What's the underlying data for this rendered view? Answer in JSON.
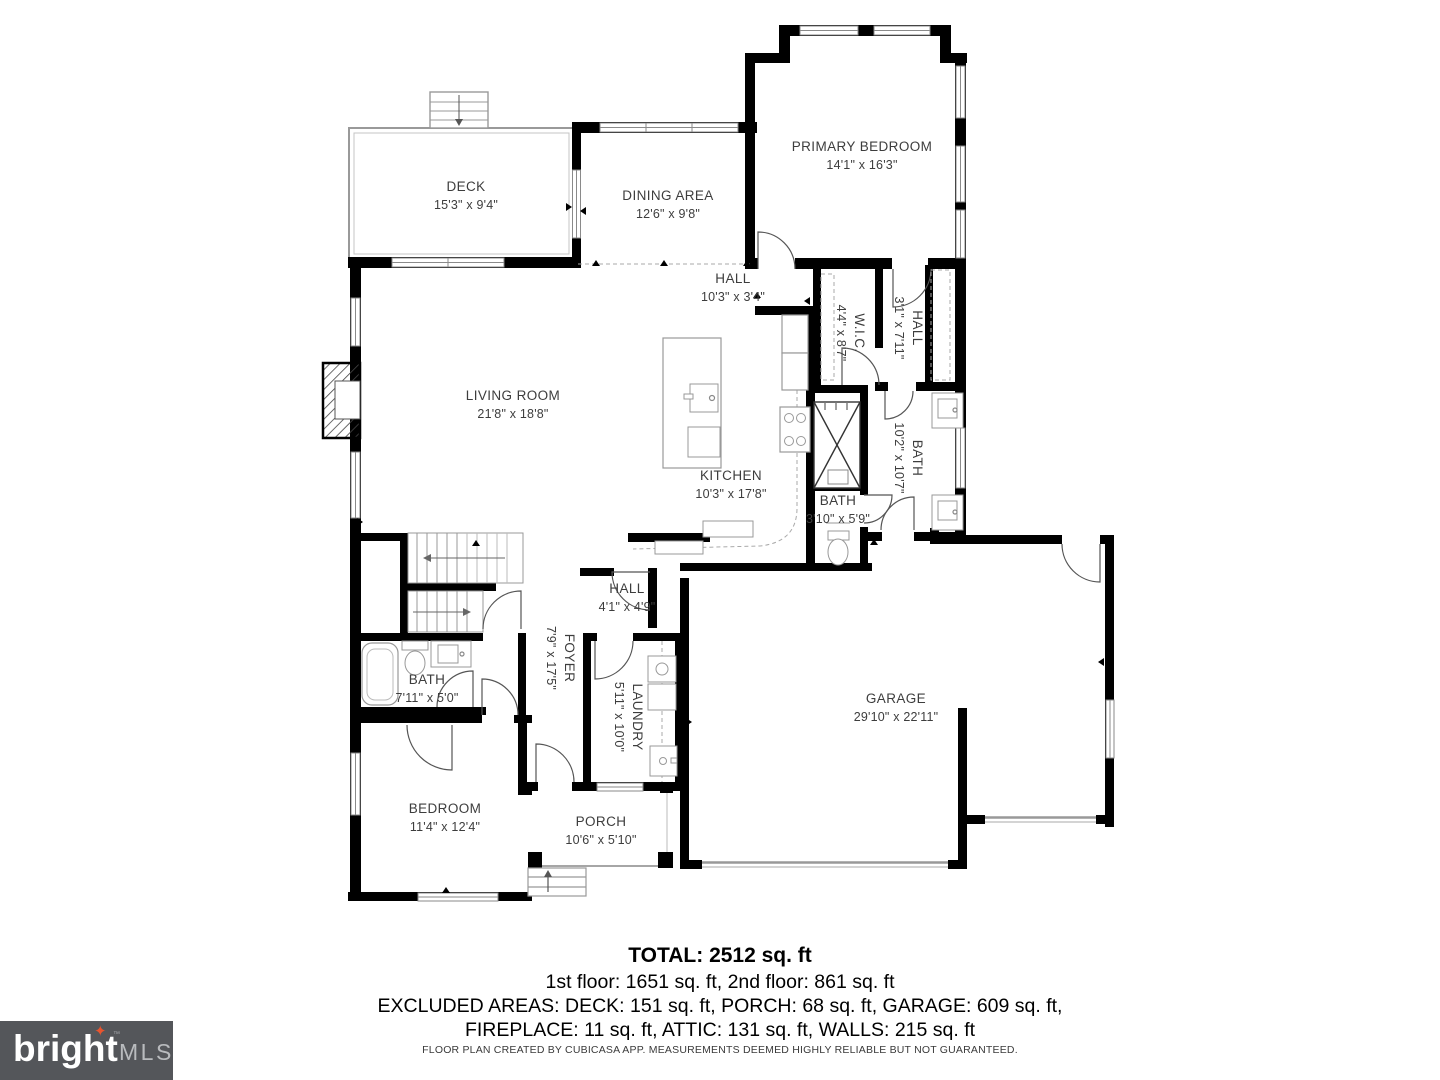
{
  "plan": {
    "rooms": [
      {
        "id": "deck",
        "name": "DECK",
        "dims": "15'3\" x 9'4\""
      },
      {
        "id": "dining",
        "name": "DINING AREA",
        "dims": "12'6\" x 9'8\""
      },
      {
        "id": "primary-bedroom",
        "name": "PRIMARY BEDROOM",
        "dims": "14'1\" x 16'3\""
      },
      {
        "id": "hall-upper",
        "name": "HALL",
        "dims": "10'3\" x 3'4\""
      },
      {
        "id": "wic",
        "name": "W.I.C.",
        "dims": "4'4\" x 8'7\""
      },
      {
        "id": "hall-closet",
        "name": "HALL",
        "dims": "3'1\" x 7'11\""
      },
      {
        "id": "living-room",
        "name": "LIVING ROOM",
        "dims": "21'8\" x 18'8\""
      },
      {
        "id": "bath-primary",
        "name": "BATH",
        "dims": "10'2\" x 10'7\""
      },
      {
        "id": "kitchen",
        "name": "KITCHEN",
        "dims": "10'3\" x 17'8\""
      },
      {
        "id": "bath-powder",
        "name": "BATH",
        "dims": "3'10\" x 5'9\""
      },
      {
        "id": "hall-lower",
        "name": "HALL",
        "dims": "4'1\" x 4'9\""
      },
      {
        "id": "foyer",
        "name": "FOYER",
        "dims": "7'9\" x 17'5\""
      },
      {
        "id": "bath-hall",
        "name": "BATH",
        "dims": "7'11\" x 5'0\""
      },
      {
        "id": "laundry",
        "name": "LAUNDRY",
        "dims": "5'11\" x 10'0\""
      },
      {
        "id": "garage",
        "name": "GARAGE",
        "dims": "29'10\" x 22'11\""
      },
      {
        "id": "bedroom",
        "name": "BEDROOM",
        "dims": "11'4\" x 12'4\""
      },
      {
        "id": "porch",
        "name": "PORCH",
        "dims": "10'6\" x 5'10\""
      }
    ]
  },
  "summary": {
    "total": "TOTAL: 2512 sq. ft",
    "floors": "1st floor: 1651 sq. ft, 2nd floor: 861 sq. ft",
    "excluded_line1": "EXCLUDED AREAS: DECK: 151 sq. ft, PORCH: 68 sq. ft, GARAGE: 609 sq. ft,",
    "excluded_line2": "FIREPLACE: 11 sq. ft, ATTIC: 131 sq. ft, WALLS: 215 sq. ft"
  },
  "footer": {
    "disclaimer": "FLOOR PLAN CREATED BY CUBICASA APP. MEASUREMENTS DEEMED HIGHLY RELIABLE BUT NOT GUARANTEED."
  },
  "logo": {
    "brand": "bright",
    "suffix": "MLS",
    "tm": "™",
    "bg_color": "#54565a",
    "star": "✦",
    "star_color": "#e8542e"
  }
}
